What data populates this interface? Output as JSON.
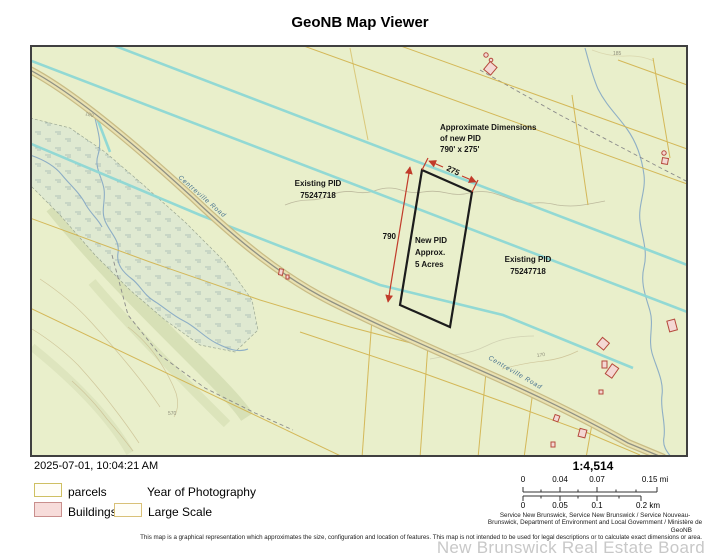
{
  "title": "GeoNB Map Viewer",
  "map": {
    "colors": {
      "background": "#e9efcb",
      "parcel_line": "#d2b24c",
      "large_scale_line": "#8ed7d4",
      "new_pid_outline": "#1c1c1c",
      "dimension_arrow": "#c13b2a",
      "building_fill": "#f4d8d4",
      "building_outline": "#b5493c",
      "stream": "#84a7c4",
      "road_fill": "#e9e1b2",
      "road_casing": "#c9bc85",
      "road_label": "#46718f",
      "wetland_fill": "#dfe9d1"
    },
    "labels": {
      "approx_dims": [
        "Approximate Dimensions",
        "of new PID",
        "790' x 275'"
      ],
      "existing_pid_left": [
        "Existing PID",
        "75247718"
      ],
      "existing_pid_right": [
        "Existing PID",
        "75247718"
      ],
      "new_pid": [
        "New PID",
        "Approx.",
        "5 Acres"
      ],
      "dim_width": "275",
      "dim_length": "790",
      "road_upper": "Centreville Road",
      "road_lower": "Centreville Road",
      "contour_570": "570",
      "contour_170": "170",
      "contour_185": "185",
      "contour_180": "180"
    }
  },
  "footer": {
    "timestamp": "2025-07-01, 10:04:21 AM",
    "legend": {
      "parcels": "parcels",
      "year_of_photography": "Year of Photography",
      "buildings": "Buildings",
      "large_scale": "Large Scale"
    },
    "scale": {
      "ratio": "1:4,514",
      "mi": [
        "0",
        "0.04",
        "0.07",
        "0.15 mi"
      ],
      "km": [
        "0",
        "0.05",
        "0.1",
        "0.2 km"
      ]
    },
    "attribution": [
      "Service New Brunswick, Service New Brunswick / Service Nouveau-",
      "Brunswick, Department of Environment and Local Government / Ministère de"
    ],
    "geonb": "GeoNB",
    "disclaimer": "This map is a graphical representation which approximates the size, configuration and location of features. This map is not intended to be used for legal descriptions or to calculate exact dimensions or area.",
    "watermark": "New Brunswick Real Estate Board"
  }
}
